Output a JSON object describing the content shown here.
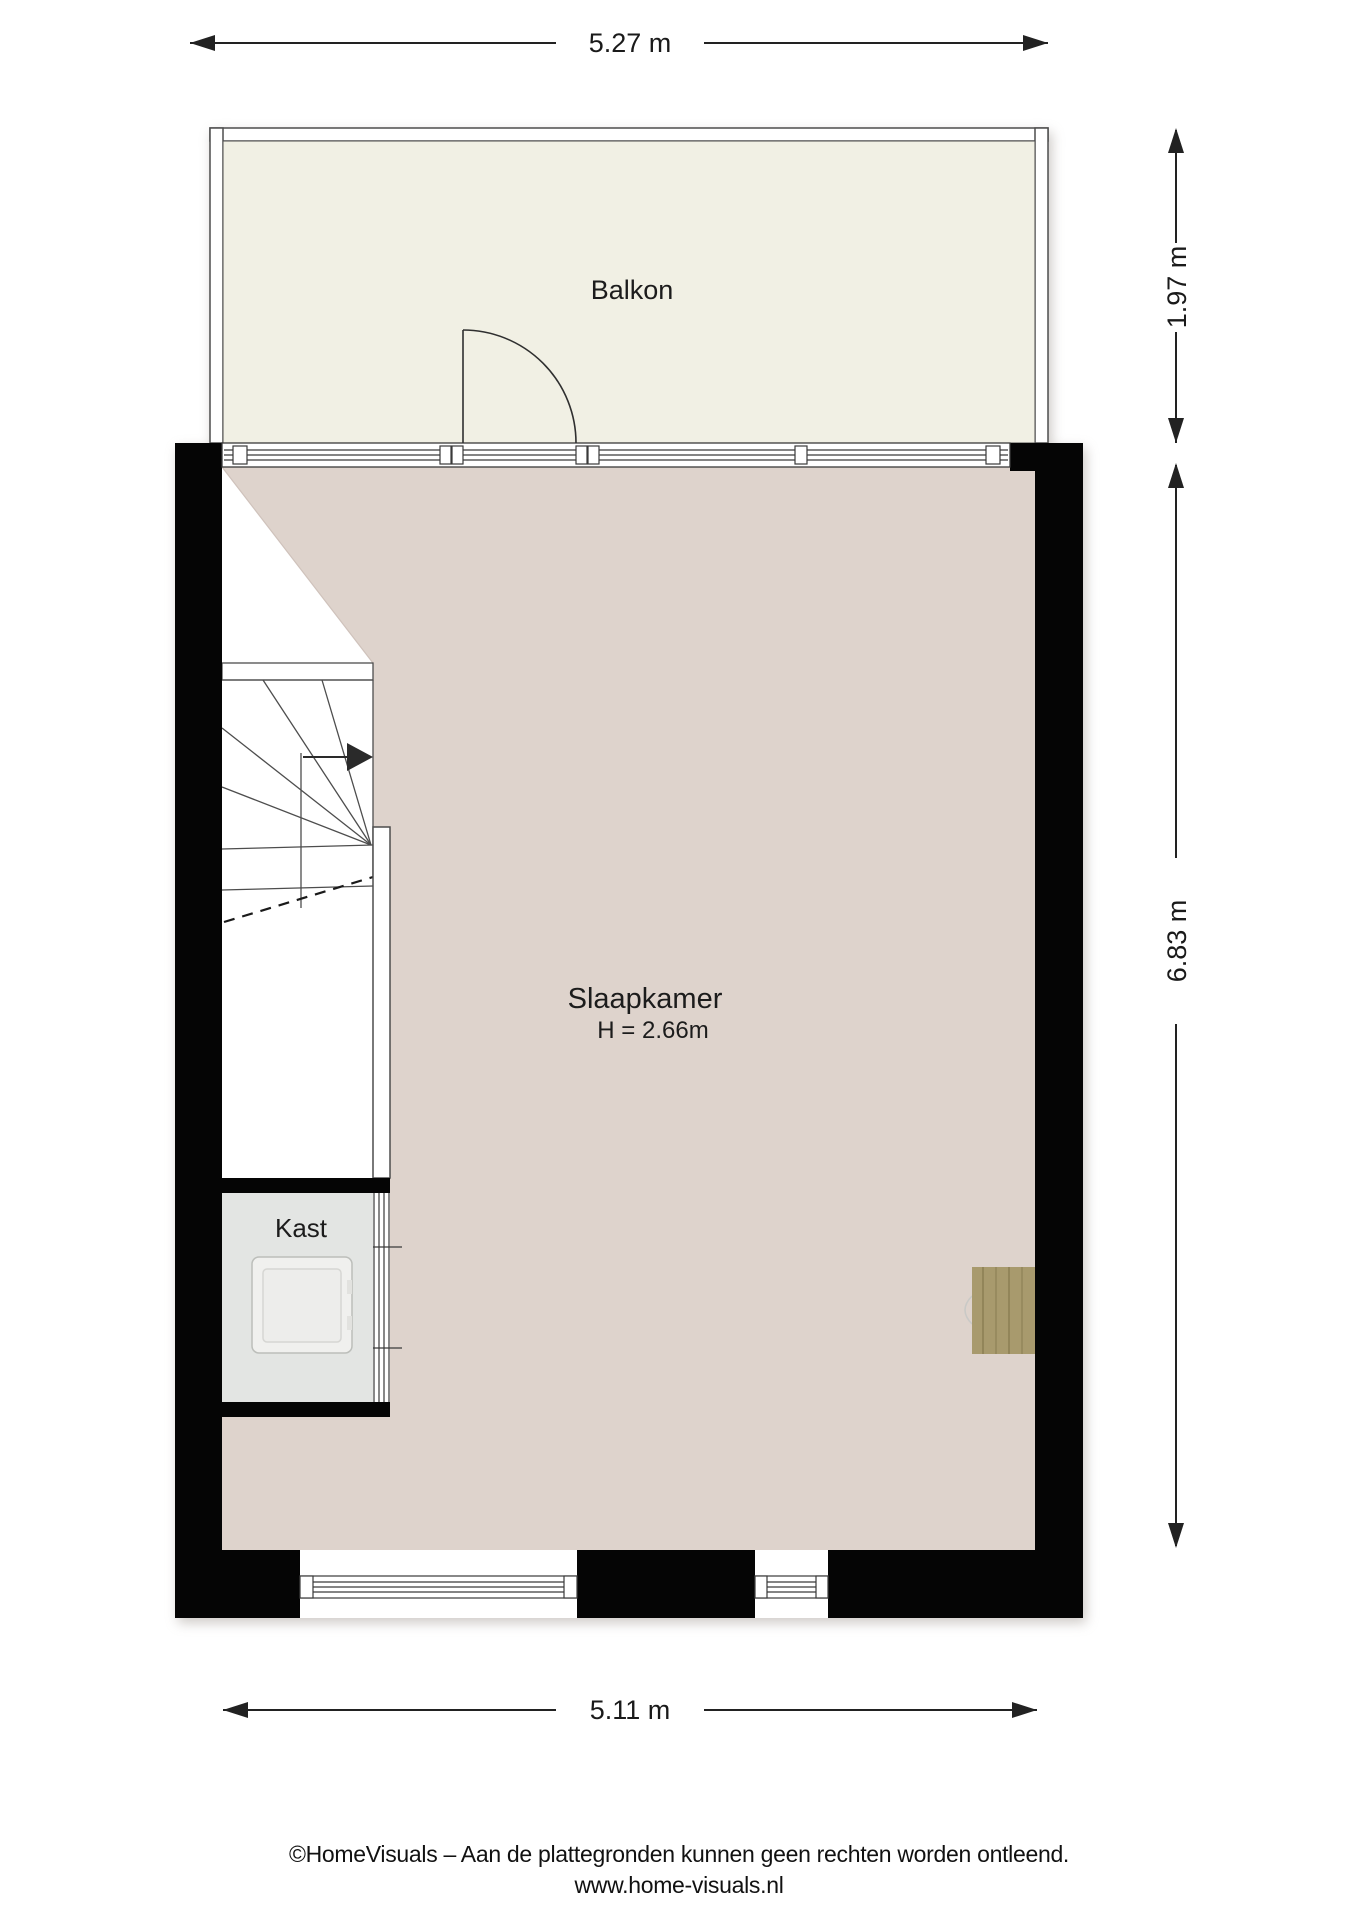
{
  "rooms": {
    "balcony": {
      "label": "Balkon"
    },
    "bedroom": {
      "label": "Slaapkamer",
      "height_note": "H = 2.66m"
    },
    "closet": {
      "label": "Kast"
    }
  },
  "dimensions": {
    "top": "5.27 m",
    "right_upper": "1.97 m",
    "right_lower": "6.83 m",
    "bottom": "5.11 m"
  },
  "footer": {
    "line1": "©HomeVisuals – Aan de plattegronden kunnen geen rechten worden ontleend.",
    "line2": "www.home-visuals.nl"
  },
  "colors": {
    "balcony_floor": "#f1f0e4",
    "bedroom_floor": "#ded3cc",
    "closet_floor": "#e3e5e3",
    "wood": "#a89a6d",
    "wall": "#050505"
  }
}
